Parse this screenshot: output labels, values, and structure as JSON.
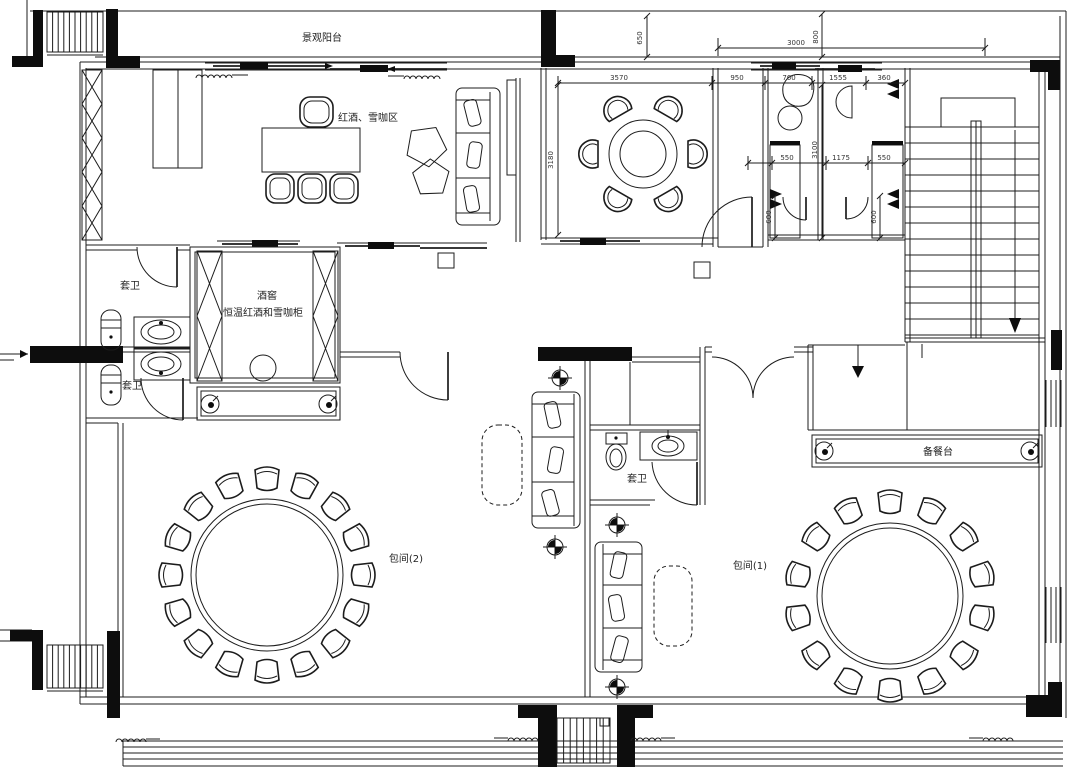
{
  "plan": {
    "labels": {
      "balcony": "景观阳台",
      "wine_coffee_area": "红酒、雪咖区",
      "cellar_title": "酒窖",
      "cellar_subtitle": "恒温红酒和雪咖柜",
      "ensuite_top": "套卫",
      "ensuite_bottom": "套卫",
      "ensuite_room1": "套卫",
      "private_room_1": "包间(1)",
      "private_room_2": "包间(2)",
      "serving_counter": "备餐台"
    },
    "dimensions": {
      "balcony_depth": "650",
      "opening_width": "3000",
      "offset_800": "800",
      "dining_width": "3570",
      "seg_950": "950",
      "seg_760": "760",
      "seg_1555": "1555",
      "seg_360": "360",
      "dining_depth": "3180",
      "counter_550_left": "550",
      "bath_depth_3100": "3100",
      "mid_1175": "1175",
      "counter_550_right": "550",
      "niche_600_left": "600",
      "niche_600_right": "600"
    },
    "tables": {
      "dining_table_seats": 6,
      "private_room_2_seats": 16,
      "private_room_1_seats": 14
    }
  }
}
